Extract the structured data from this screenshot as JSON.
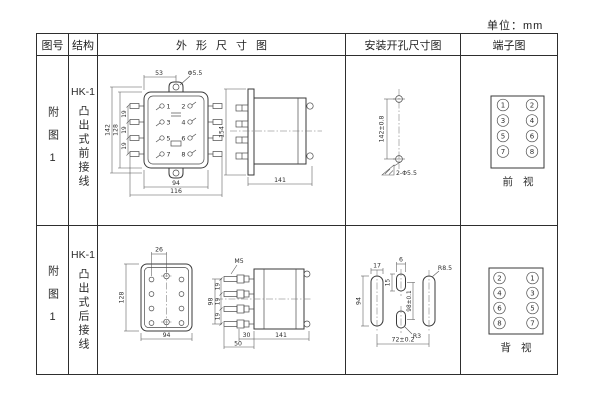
{
  "unit_label": "单位：mm",
  "table": {
    "headers": [
      "图号",
      "结构",
      "外形尺寸图",
      "安装开孔尺寸图",
      "端子图"
    ]
  },
  "rows": [
    {
      "figure_no": "附图1",
      "model": "HK-1",
      "structure": "凸出式前接线",
      "outline": {
        "front": {
          "dim_top": "53",
          "hole": "Φ5.5",
          "h_outer": "142",
          "h_inner": "128",
          "pitch": [
            "19",
            "19",
            "19"
          ],
          "w_inner": "94",
          "w_outer": "116",
          "terminals": [
            "1",
            "2",
            "3",
            "4",
            "5",
            "6",
            "7",
            "8"
          ]
        },
        "side": {
          "height": "154",
          "depth": "141"
        }
      },
      "mounting": {
        "spacing": "142±0.8",
        "holes": "2-Φ5.5"
      },
      "terminals": {
        "left": [
          "1",
          "3",
          "5",
          "7"
        ],
        "right": [
          "2",
          "4",
          "6",
          "8"
        ],
        "view": "前视"
      }
    },
    {
      "figure_no": "附图1",
      "model": "HK-1",
      "structure": "凸出式后接线",
      "outline": {
        "rear": {
          "dim_top": "26",
          "height": "128",
          "width": "94"
        },
        "side": {
          "screw": "M5",
          "height": "98",
          "pitch": [
            "19",
            "19",
            "19"
          ],
          "thread": "30",
          "stud": "50",
          "depth": "141"
        }
      },
      "mounting": {
        "slot_w": "17",
        "slot_h": "94",
        "mid_w": "6",
        "mid_h": "15",
        "mid_spacing": "98±0.1",
        "radius": "R8.5",
        "mid_radius": "R3",
        "h_spacing": "72±0.2"
      },
      "terminals": {
        "left": [
          "2",
          "4",
          "6",
          "8"
        ],
        "right": [
          "1",
          "3",
          "5",
          "7"
        ],
        "view": "背视"
      }
    }
  ]
}
